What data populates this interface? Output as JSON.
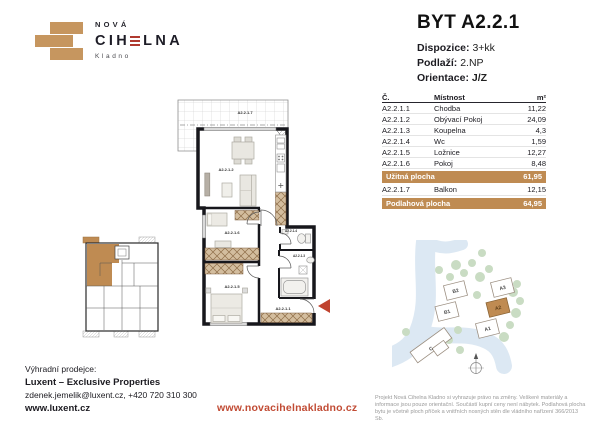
{
  "colors": {
    "accent_tan": "#BF8B52",
    "accent_red": "#C14B34",
    "ink": "#1C1B21"
  },
  "logo": {
    "top": "NOVÁ",
    "main_left": "CIH",
    "main_right": "LNA",
    "sub": "Kladno"
  },
  "header": {
    "title": "BYT A2.2.1",
    "rows": [
      {
        "label": "Dispozice:",
        "value": "3+kk"
      },
      {
        "label": "Podlaží:",
        "value": "2.NP"
      },
      {
        "label": "Orientace:",
        "value": "J/Z"
      }
    ]
  },
  "table": {
    "col_code": "Č.",
    "col_room": "Místnost",
    "col_area": "m²",
    "rows": [
      {
        "code": "A2.2.1.1",
        "room": "Chodba",
        "area": "11,22"
      },
      {
        "code": "A2.2.1.2",
        "room": "Obývací Pokoj",
        "area": "24,09"
      },
      {
        "code": "A2.2.1.3",
        "room": "Koupelna",
        "area": "4,3"
      },
      {
        "code": "A2.2.1.4",
        "room": "Wc",
        "area": "1,59"
      },
      {
        "code": "A2.2.1.5",
        "room": "Ložnice",
        "area": "12,27"
      },
      {
        "code": "A2.2.1.6",
        "room": "Pokoj",
        "area": "8,48"
      }
    ],
    "uzitna": {
      "label": "Užitná plocha",
      "value": "61,95"
    },
    "balkon": {
      "code": "A2.2.1.7",
      "room": "Balkon",
      "area": "12,15"
    },
    "podlahova": {
      "label": "Podlahová plocha",
      "value": "64,95"
    }
  },
  "floorplan": {
    "labels": {
      "balkon": "A2.2.1.7",
      "obyvaci_pokoj": "A2.2.1.2",
      "pokoj": "A2.2.1.6",
      "loznice": "A2.2.1.5",
      "chodba": "A2.2.1.1",
      "wc": "A2.2.1.4",
      "koupelna": "A2.2.1.3"
    }
  },
  "siteplan": {
    "labels": {
      "b2": "B2",
      "b1": "B1",
      "a3": "A3",
      "a2": "A2",
      "a1": "A1",
      "c": "C"
    },
    "highlighted": "A2"
  },
  "footer": {
    "seller_label": "Výhradní prodejce:",
    "seller_name": "Luxent – Exclusive Properties",
    "contact": "zdenek.jemelik@luxent.cz, +420 720 310 300",
    "seller_web": "www.luxent.cz",
    "project_web": "www.novacihelnakladno.cz",
    "disclaimer": "Projekt Nová Cihelna Kladno si vyhrazuje právo na změny. Veškeré materiály a informace jsou pouze orientační. Součástí kupní ceny není nábytek. Podlahová plocha bytu je včetně ploch příček a vnitřních nosných stěn dle vládního nařízení 366/2013 Sb."
  }
}
